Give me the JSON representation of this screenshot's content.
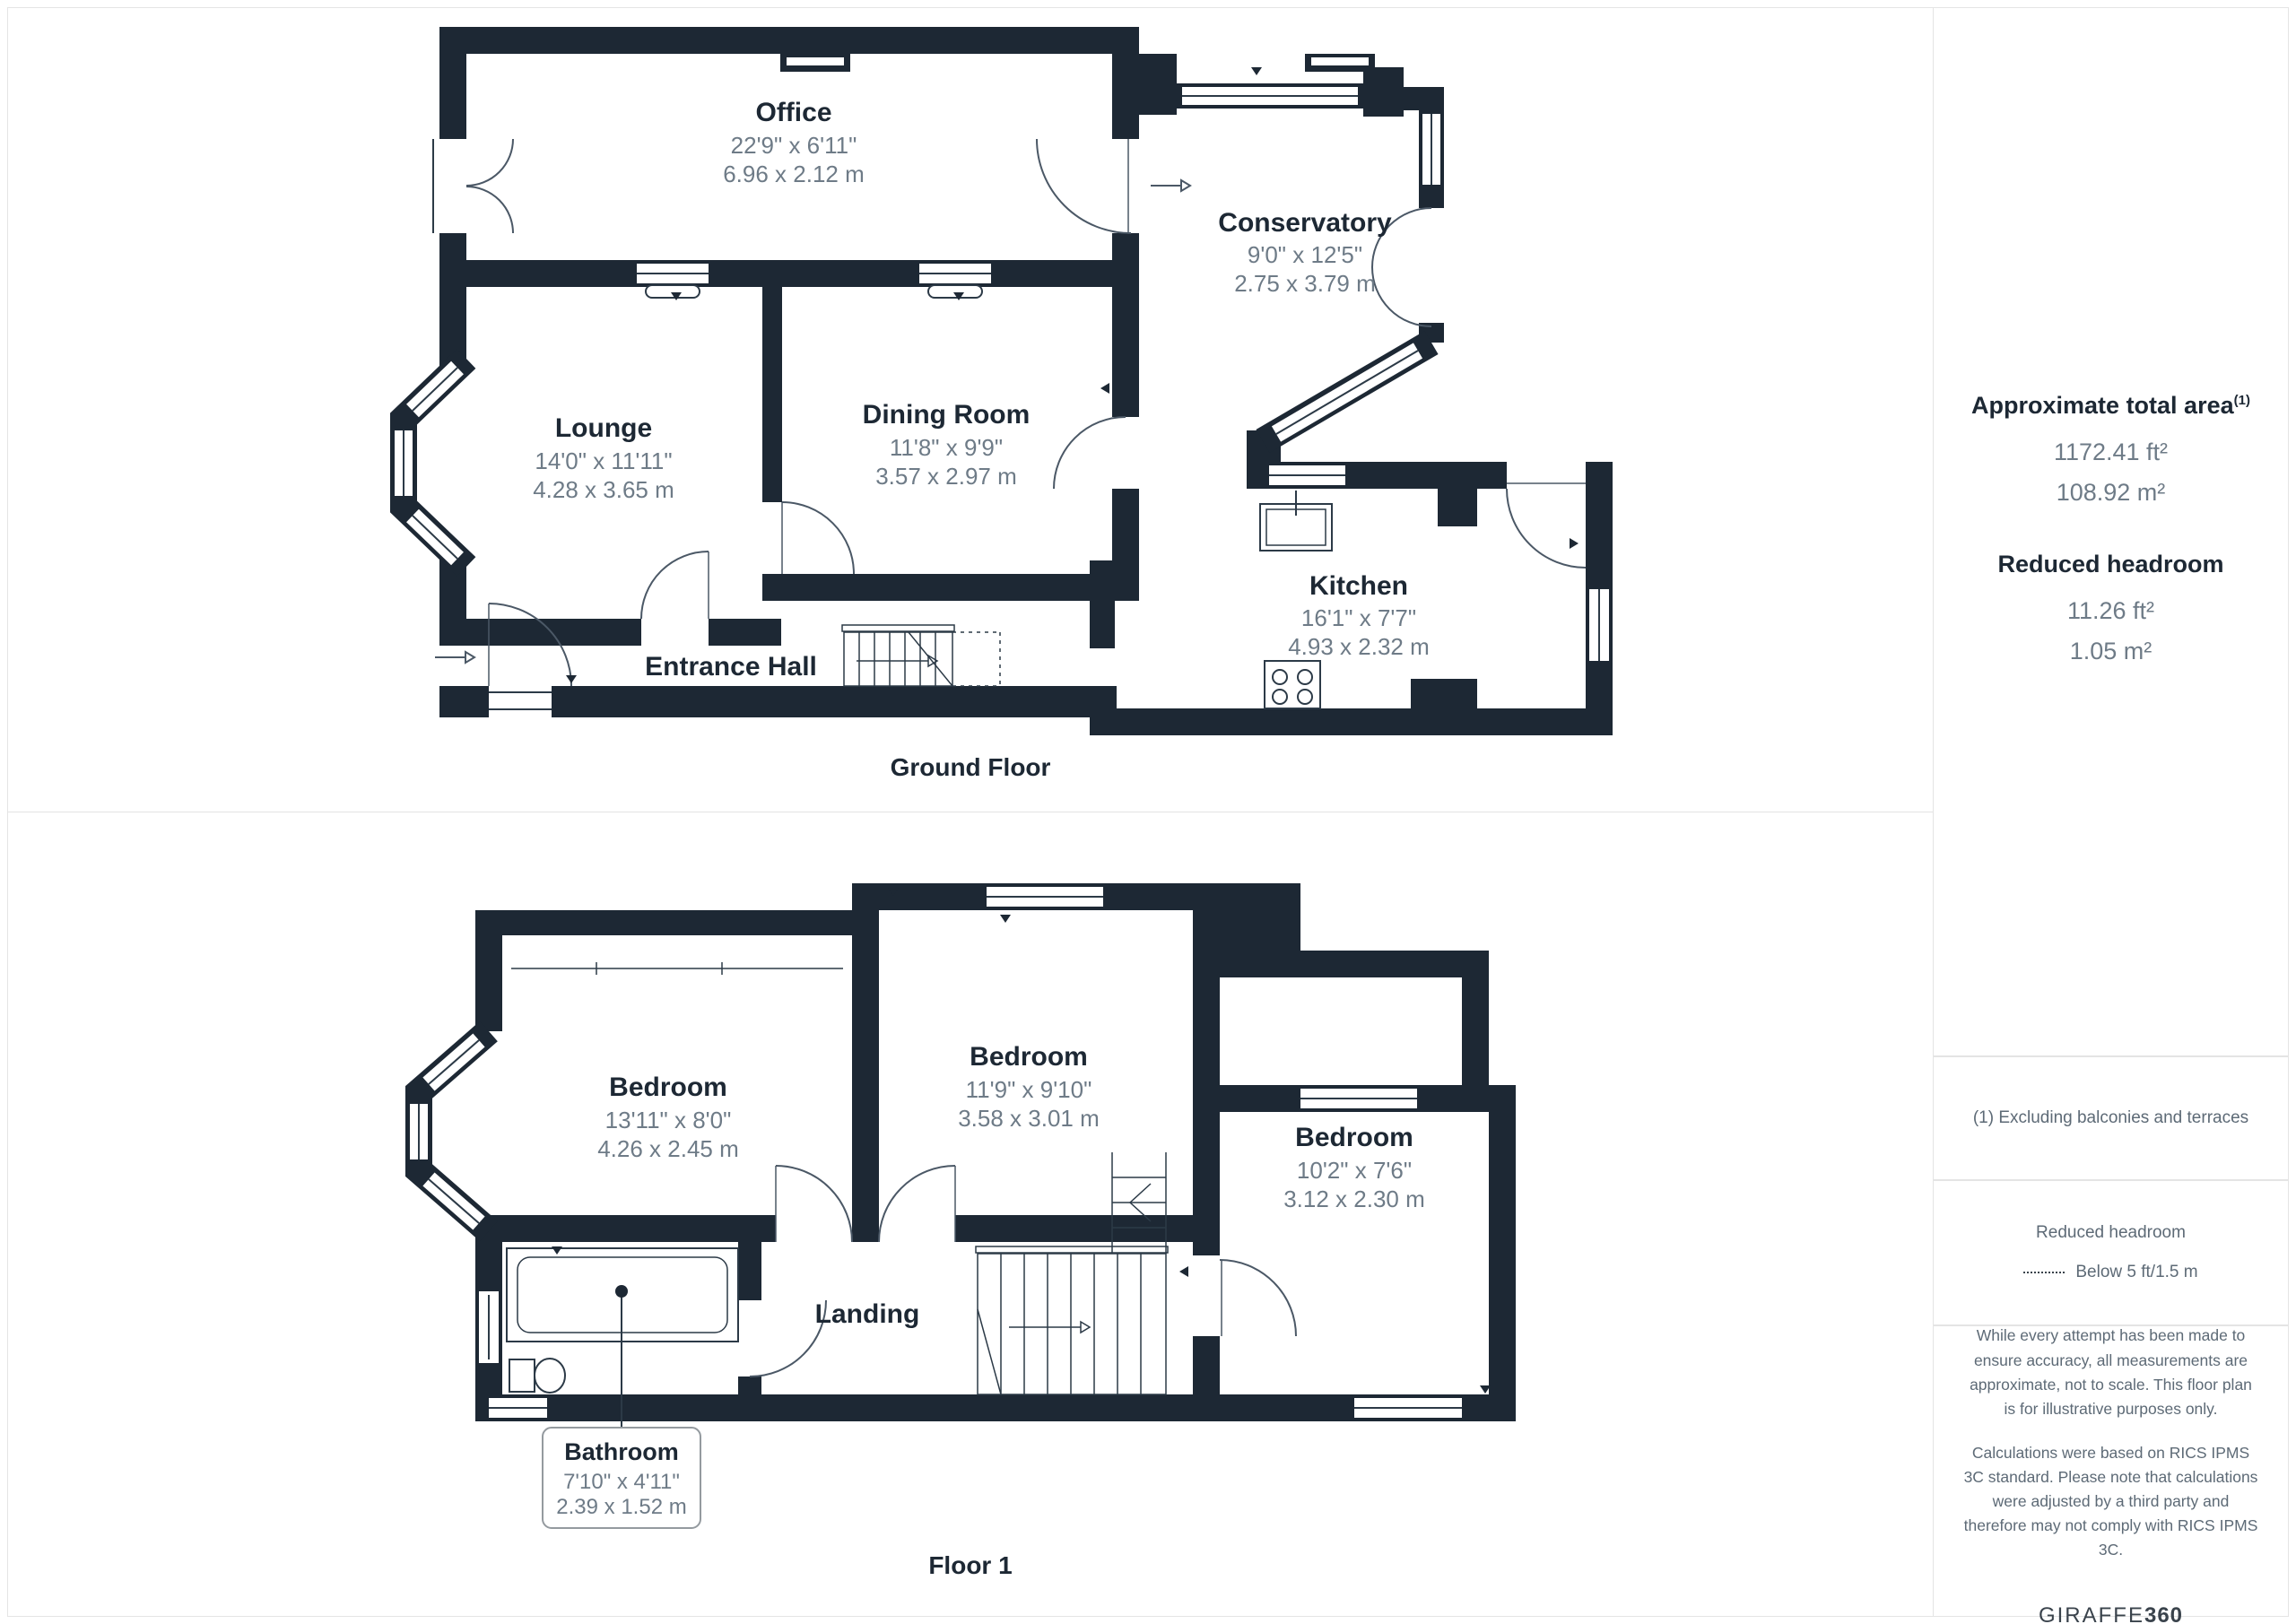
{
  "floors": {
    "ground": {
      "caption": "Ground Floor",
      "rooms": {
        "office": {
          "name": "Office",
          "imperial": "22'9\" x 6'11\"",
          "metric": "6.96 x 2.12 m"
        },
        "conservatory": {
          "name": "Conservatory",
          "imperial": "9'0\" x 12'5\"",
          "metric": "2.75 x 3.79 m"
        },
        "lounge": {
          "name": "Lounge",
          "imperial": "14'0\" x 11'11\"",
          "metric": "4.28 x 3.65 m"
        },
        "dining": {
          "name": "Dining Room",
          "imperial": "11'8\" x 9'9\"",
          "metric": "3.57 x 2.97 m"
        },
        "kitchen": {
          "name": "Kitchen",
          "imperial": "16'1\" x 7'7\"",
          "metric": "4.93 x 2.32 m"
        },
        "entrance": {
          "name": "Entrance Hall"
        }
      }
    },
    "first": {
      "caption": "Floor 1",
      "rooms": {
        "bedroom1": {
          "name": "Bedroom",
          "imperial": "13'11\" x 8'0\"",
          "metric": "4.26 x 2.45 m"
        },
        "bedroom2": {
          "name": "Bedroom",
          "imperial": "11'9\" x 9'10\"",
          "metric": "3.58 x 3.01 m"
        },
        "bedroom3": {
          "name": "Bedroom",
          "imperial": "10'2\" x 7'6\"",
          "metric": "3.12 x 2.30 m"
        },
        "landing": {
          "name": "Landing"
        },
        "bathroom": {
          "name": "Bathroom",
          "imperial": "7'10\" x 4'11\"",
          "metric": "2.39 x 1.52 m"
        }
      }
    }
  },
  "sidebar": {
    "total_area": {
      "title": "Approximate total area",
      "superscript": "(1)",
      "imperial": "1172.41 ft²",
      "metric": "108.92 m²"
    },
    "reduced_headroom": {
      "title": "Reduced headroom",
      "imperial": "11.26 ft²",
      "metric": "1.05 m²"
    },
    "footnote": "(1) Excluding balconies and terraces",
    "legend": {
      "title": "Reduced headroom",
      "label": "Below 5 ft/1.5 m"
    },
    "disclaimer1": "While every attempt has been made to ensure accuracy, all measurements are approximate, not to scale. This floor plan is for illustrative purposes only.",
    "disclaimer2": "Calculations were based on RICS IPMS 3C standard. Please note that calculations were adjusted by a third party and therefore may not comply with RICS IPMS 3C.",
    "brand": {
      "name": "GIRAFFE",
      "suffix": "360"
    }
  },
  "colors": {
    "wall": "#1d2834",
    "dim_text": "#6e7b87",
    "arc_line": "#4b5866",
    "panel_border": "#e4e4e4"
  }
}
